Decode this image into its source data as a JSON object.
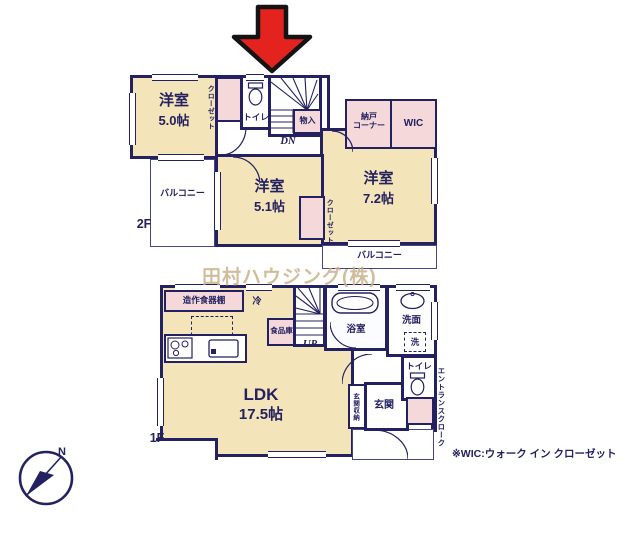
{
  "watermark": "田村ハウジング(株)",
  "footnote": "※WIC:ウォーク イン クローゼット",
  "compass": {
    "north": "N"
  },
  "colors": {
    "wall_navy": "#23215f",
    "room_beige": "#f4e4ba",
    "closet_pink": "#f5d9da",
    "arrow_red": "#e5231e",
    "watermark_tan": "#c9b28b"
  },
  "icons": {
    "entrance_arrow": "entrance-arrow-icon",
    "compass": "compass-icon",
    "toilet": "toilet-icon",
    "bathtub": "bathtub-icon",
    "washbasin": "sink-icon",
    "stove": "stove-icon",
    "kitchen_sink": "kitchen-sink-icon",
    "stairs": "stairs-icon"
  },
  "floor2": {
    "label": "2F",
    "room_5_0": {
      "name": "洋室",
      "size": "5.0帖"
    },
    "room_5_1": {
      "name": "洋室",
      "size": "5.1帖"
    },
    "room_7_2": {
      "name": "洋室",
      "size": "7.2帖"
    },
    "closet_left": "クローゼット",
    "closet_right": "クローゼット",
    "toilet": "トイレ",
    "storage": "物入",
    "nando_corner": "納戸\nコーナー",
    "wic": "WIC",
    "balcony_left": "バルコニー",
    "balcony_bottom": "バルコニー",
    "stairs_dn": "DN"
  },
  "floor1": {
    "label": "1F",
    "ldk": {
      "name": "LDK",
      "size": "17.5帖"
    },
    "cupboard": "造作食器棚",
    "fridge": "冷",
    "pantry": "食品庫",
    "stairs_up": "UP",
    "bath": "浴室",
    "washroom": "洗面",
    "laundry": "洗",
    "toilet": "トイレ",
    "entrance": "玄関",
    "entrance_storage": "玄関収納",
    "entrance_cloak": "エントランスクローク"
  }
}
